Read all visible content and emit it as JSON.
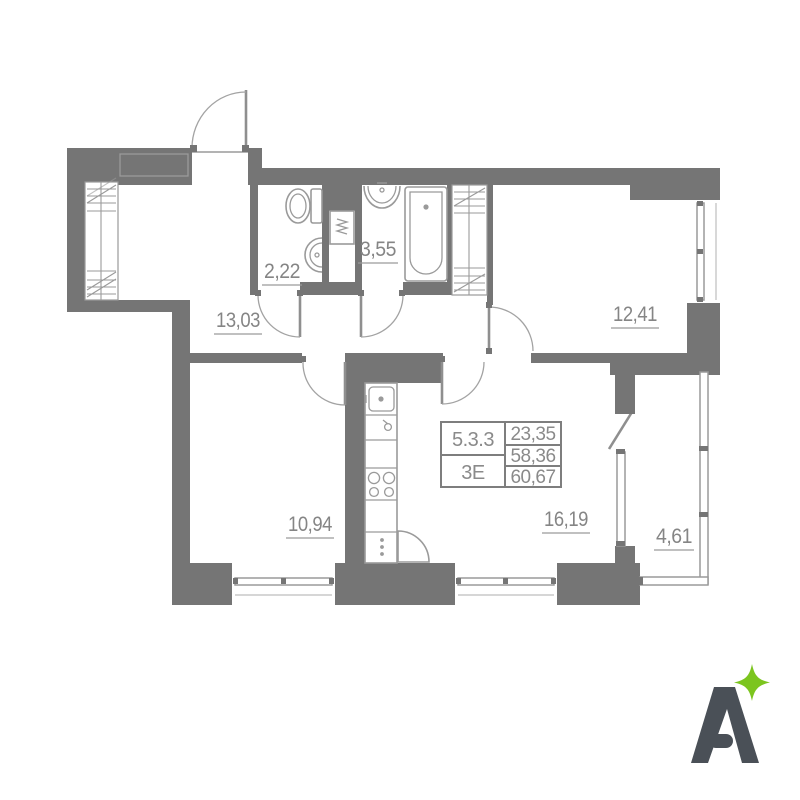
{
  "info_table": {
    "unit_number": "5.3.3",
    "unit_type": "3Е",
    "area_living": "23,35",
    "area_without_balcony": "58,36",
    "area_total": "60,67"
  },
  "rooms": {
    "hallway": "13,03",
    "wc": "2,22",
    "bathroom": "3,55",
    "bedroom": "12,41",
    "room2": "10,94",
    "kitchen_living": "16,19",
    "balcony": "4,61"
  },
  "icons": {
    "washing_machine": "washing-machine",
    "toilet": "toilet",
    "bathtub": "bathtub",
    "sink": "sink",
    "stove": "stove",
    "sparkle": "sparkle-star"
  },
  "logo": {
    "letter": "A"
  },
  "colors": {
    "wall": "#757575",
    "lines": "#9a9a9a",
    "label_text": "#858585",
    "logo_letter": "#4a5057",
    "accent_green": "#7cc51f"
  }
}
